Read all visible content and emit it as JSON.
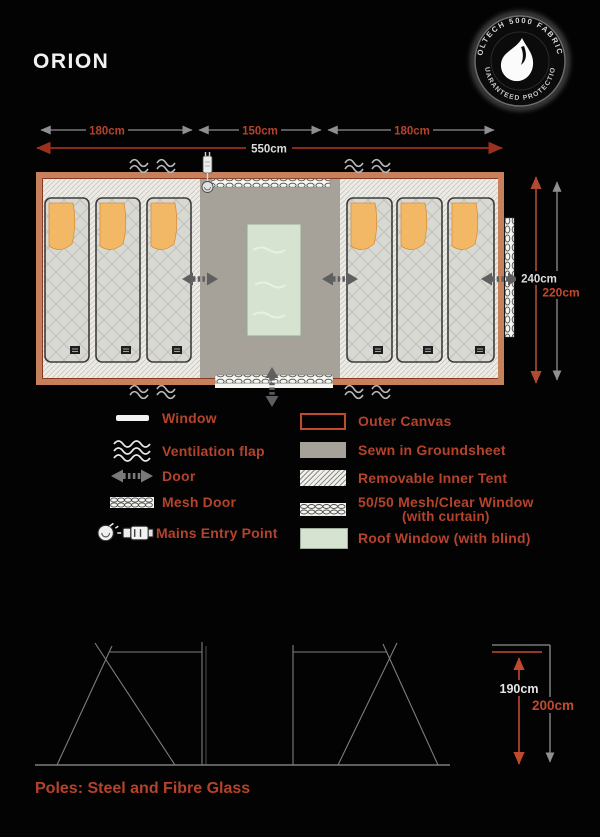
{
  "title": "ORION",
  "badge": {
    "arc_top": "OLTECH 5000 FABRIC",
    "arc_bottom": "GUARANTEED PROTECTION"
  },
  "plan": {
    "dims": {
      "section_left": "180cm",
      "section_center": "150cm",
      "section_right": "180cm",
      "total_width": "550cm",
      "depth_outer": "240cm",
      "depth_inner": "220cm"
    }
  },
  "legend": {
    "left": [
      {
        "icon": "window-icon",
        "label": "Window"
      },
      {
        "icon": "ventilation-flap-icon",
        "label": "Ventilation flap"
      },
      {
        "icon": "door-icon",
        "label": "Door"
      },
      {
        "icon": "mesh-door-icon",
        "label": "Mesh Door"
      },
      {
        "icon": "mains-entry-icon",
        "label": "Mains Entry Point"
      }
    ],
    "right": [
      {
        "icon": "outer-canvas-swatch",
        "label": "Outer Canvas"
      },
      {
        "icon": "groundsheet-swatch",
        "label": "Sewn in Groundsheet"
      },
      {
        "icon": "inner-tent-swatch",
        "label": "Removable Inner Tent"
      },
      {
        "icon": "mesh-clear-window-swatch",
        "label": "50/50 Mesh/Clear Window",
        "sublabel": "(with curtain)"
      },
      {
        "icon": "roof-window-swatch",
        "label": "Roof Window (with blind)"
      }
    ]
  },
  "elevation": {
    "inner_height": "190cm",
    "outer_height": "200cm",
    "note": "Poles: Steel and Fibre Glass"
  },
  "colors": {
    "accent_text": "#b5432c",
    "canvas_border": "#c6815c",
    "groundsheet": "#a6a299",
    "roof_window": "#d6e3d1",
    "pillow": "#f3b866",
    "dim_grey": "#8f8f8f",
    "dim_red": "#9c2f1e"
  }
}
